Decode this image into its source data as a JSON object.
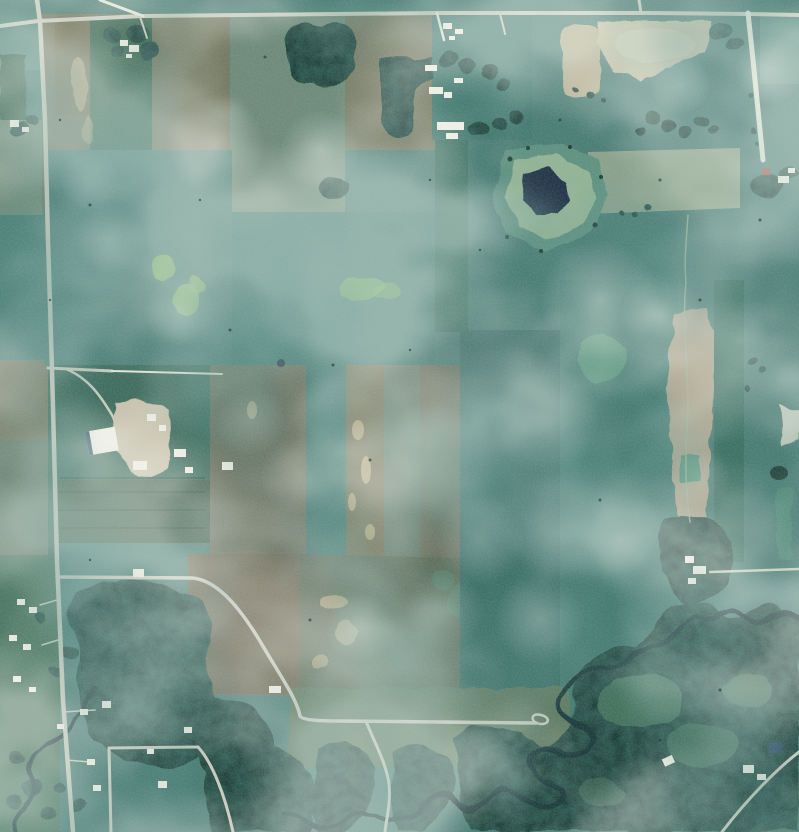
{
  "scene": {
    "type": "aerial-photograph",
    "subject": "rural farmland seen from above: rectangular crop fields, section roads, farmsteads, a ringed pond, dense bottomland forest and a meandering river",
    "style": "scanned film aerial survey photo with teal-green color cast and heavy grain",
    "season_hint": "summer"
  },
  "palette": {
    "base_teal": "#4a7d75",
    "teal_light": "#56897f",
    "teal_mid": "#437a71",
    "teal_dark": "#3c6f68",
    "green_dark": "#3a6652",
    "green_crop": "#3f6d5f",
    "green_strip": "#3e7265",
    "green_row": "#44604f",
    "green_res": "#48735f",
    "green_bright": "#7eb369",
    "green_bright2": "#6cab5f",
    "green_meadow": "#52907a",
    "green_clearing": "#4c7a60",
    "sage": "#6e8a7a",
    "sage_light": "#91a68f",
    "gray_green": "#667c6d",
    "gray_brown": "#757a64",
    "brown_field": "#747259",
    "brown_mid": "#6e7361",
    "brown_dark": "#6f6a57",
    "brown_mottle": "#5f6f5c",
    "grass_flat": "#5e7a62",
    "tan_field": "#b5b193",
    "tan_strip": "#a8a18b",
    "tan_streak": "#c0b088",
    "cream_field": "#c6c0a3",
    "cream_light": "#d5cfb3",
    "light_patch": "#ccd3c2",
    "forest": "#1e3e37",
    "water": "#1c3a3e",
    "pond_dark": "#223649",
    "pond_ring_outer": "#5f9181",
    "pond_ring_light": "#93b496",
    "road": "#c8ccc0",
    "road_bright": "#e3e6d9",
    "trail": "#9db39a",
    "building_white": "#f0efe6",
    "roof_red": "#a34f41",
    "roof_blue": "#31506b",
    "yard_gravel": "#c9c3ae",
    "cloud": "#edf2e9",
    "shadow": "#275350",
    "speck": "#152a27"
  },
  "features": {
    "roads": [
      "highway-top",
      "highway-left",
      "gravel-road-right",
      "farm-spur-road",
      "country-road-southeast",
      "river-road-branch",
      "residential-streets",
      "bottom-right-road",
      "east-farm-road"
    ],
    "water": [
      "ringed-pond",
      "meandering-river",
      "creek"
    ],
    "land": [
      "crop-fields",
      "fallow-fields",
      "striped-fields",
      "pasture",
      "forest",
      "tree-groves",
      "meadow-clearings"
    ],
    "structures": [
      "farmstead-north",
      "farmstead-northeast",
      "farmstead-east",
      "farm-complex-west",
      "farmstead-mid-east",
      "rural-houses",
      "bottom-right-buildings"
    ]
  }
}
